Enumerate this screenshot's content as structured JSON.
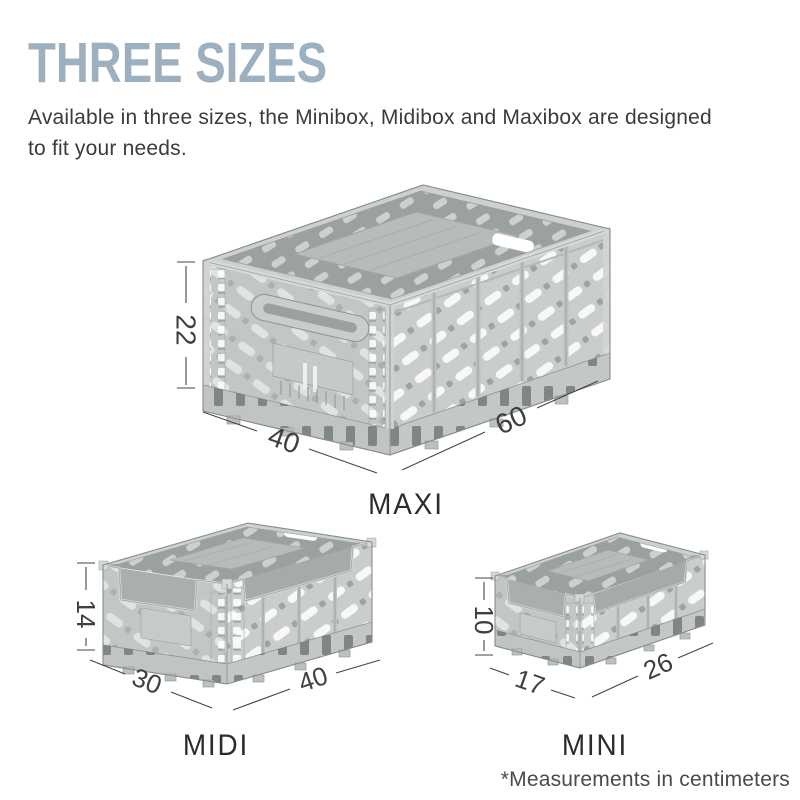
{
  "header": {
    "title": "THREE SIZES",
    "subtitle_line1": "Available in three sizes, the Minibox, Midibox and Maxibox are designed",
    "subtitle_line2": "to fit your needs."
  },
  "crates": [
    {
      "name": "MAXI",
      "height_cm": "22",
      "depth_cm": "40",
      "width_cm": "60"
    },
    {
      "name": "MIDI",
      "height_cm": "14",
      "depth_cm": "30",
      "width_cm": "40"
    },
    {
      "name": "MINI",
      "height_cm": "10",
      "depth_cm": "17",
      "width_cm": "26"
    }
  ],
  "footer": {
    "note": "*Measurements in centimeters"
  },
  "colors": {
    "title": "#9db0c0",
    "body_text": "#3b3b3b",
    "dimension_text": "#3f3f3f",
    "crate_body": "#c7cbca",
    "crate_interior": "#9ba19f"
  }
}
